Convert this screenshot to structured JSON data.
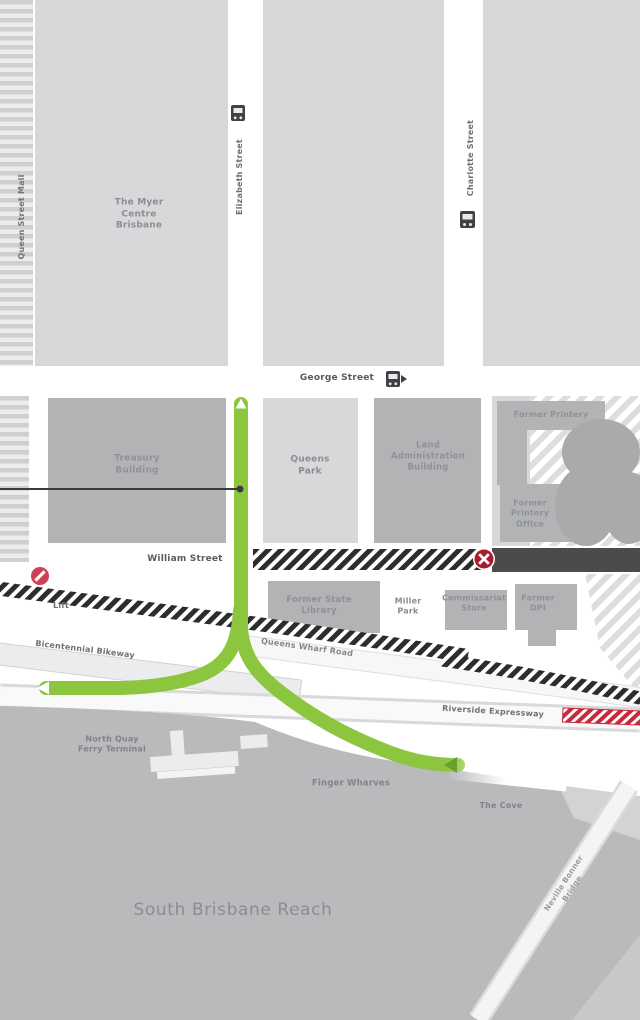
{
  "labels": {
    "queen_street_mall": "Queen Street Mall",
    "myer_centre": "The Myer\nCentre\nBrisbane",
    "elizabeth_street": "Elizabeth Street",
    "charlotte_street": "Charlotte Street",
    "george_street": "George Street",
    "treasury_building": "Treasury\nBuilding",
    "queens_park": "Queens\nPark",
    "land_administration_building": "Land\nAdministration\nBuilding",
    "former_printery": "Former Printery",
    "former_printery_office": "Former\nPrintery\nOffice",
    "william_street": "William Street",
    "lift": "Lift",
    "former_state_library": "Former State\nLibrary",
    "miller_park": "Miller\nPark",
    "commissariat_store": "Commissariat\nStore",
    "former_dpi": "Former\nDPI",
    "bicentennial_bikeway": "Bicentennial Bikeway",
    "queens_wharf_road": "Queens Wharf Road",
    "riverside_expressway": "Riverside Expressway",
    "north_quay_ferry_terminal": "North Quay\nFerry Terminal",
    "finger_wharves": "Finger Wharves",
    "the_cove": "The Cove",
    "south_brisbane_reach": "South Brisbane Reach",
    "neville_bonner_bridge": "Neville Bonner Bridge"
  },
  "icons": {
    "bus_stops": [
      "elizabeth-street-bus-stop",
      "george-street-bus-stop",
      "charlotte-street-bus-stop"
    ],
    "closed_markers": [
      "lift-closed",
      "william-street-closed"
    ],
    "closure_band": "riverside-expressway-closure"
  },
  "colors": {
    "route_green": "#8cc63e",
    "route_green_dark": "#66a12f",
    "closure_hatch_dark": "#2d2d2f",
    "closure_red": "#c8293b",
    "road_closed_fill": "#4a4b4d",
    "city_block": "#d7d8d9",
    "building": "#b1b3b5",
    "water": "#b9babc"
  }
}
